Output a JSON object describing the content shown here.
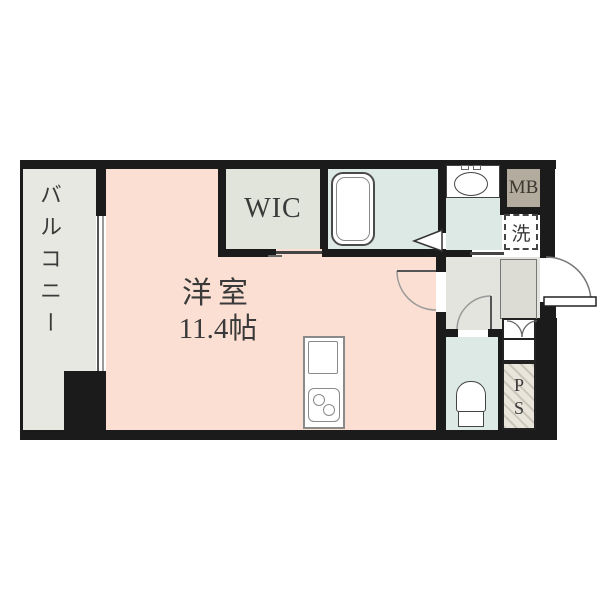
{
  "floorplan": {
    "balcony": {
      "label": "バルコニー"
    },
    "main_room": {
      "label": "洋室",
      "size": "11.4帖"
    },
    "wic": {
      "label": "WIC"
    },
    "meter_box": {
      "label": "MB"
    },
    "washer": {
      "label": "洗"
    },
    "pipe_space": {
      "line1": "P",
      "line2": "S"
    },
    "colors": {
      "wall": "#1b1b1b",
      "room": "#fbdfd2",
      "balcony": "#e8e8e2",
      "wic": "#e1e4db",
      "wet_area": "#dce9e4",
      "hallway": "#e4e4de",
      "genkan": "#dcdbd4",
      "meter_box": "#b2ab9e",
      "text": "#3a3a3a"
    }
  }
}
